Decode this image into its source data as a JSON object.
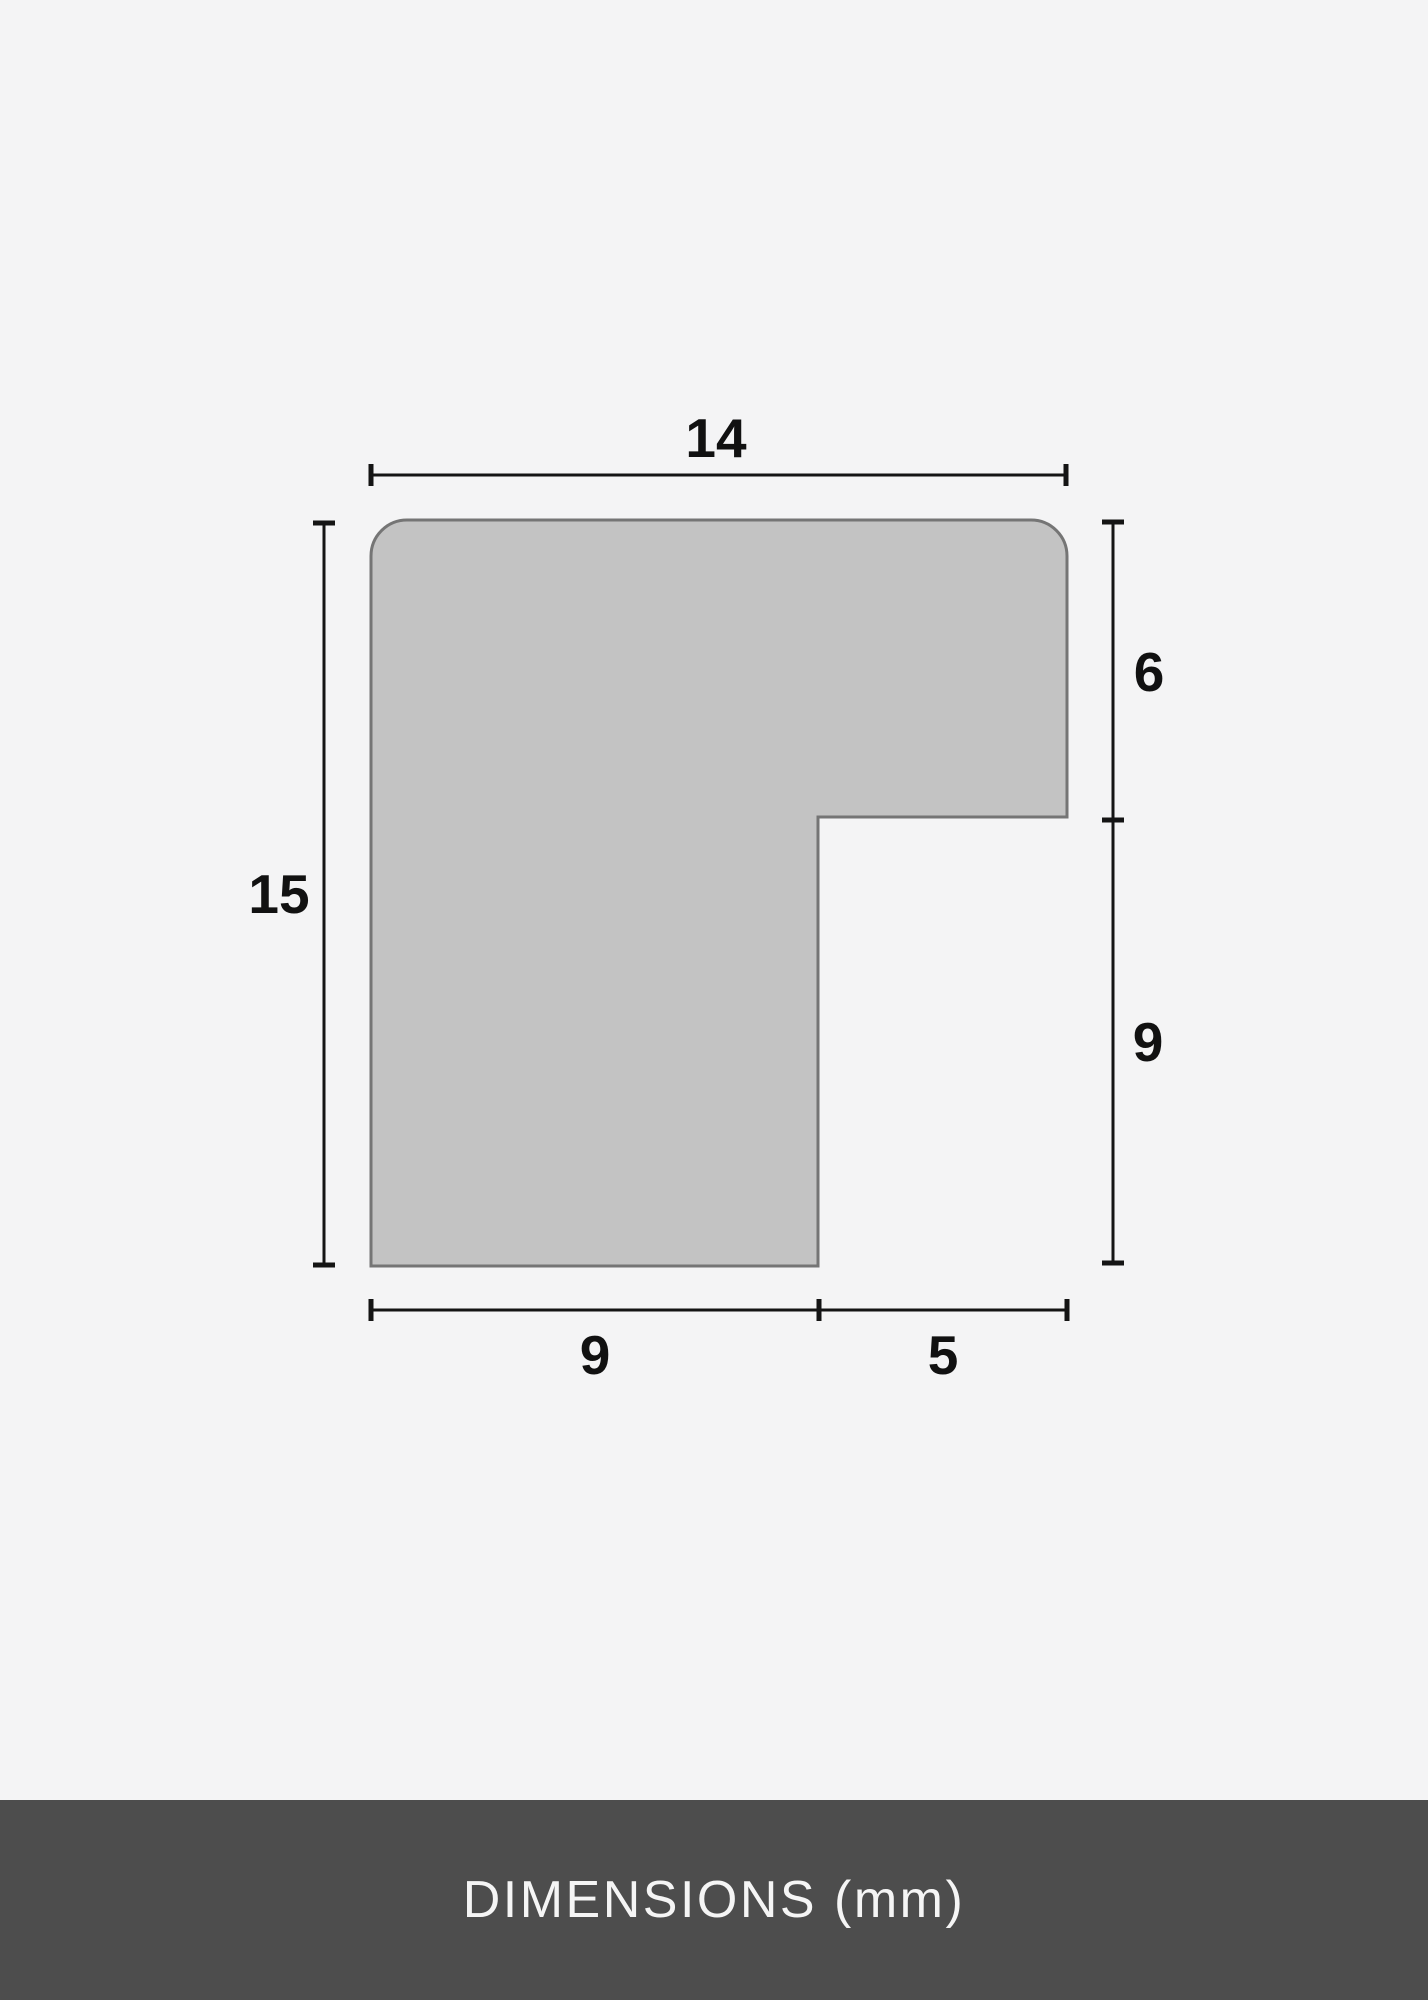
{
  "diagram": {
    "unit": "mm",
    "dimensions": {
      "top_width": "14",
      "left_height": "15",
      "right_upper": "6",
      "right_lower": "9",
      "bottom_left": "9",
      "bottom_right": "5"
    }
  },
  "footer": {
    "label": "DIMENSIONS (mm)"
  },
  "colors": {
    "background": "#f4f4f5",
    "shape_fill": "#c3c3c3",
    "shape_stroke": "#757575",
    "dimension_line": "#141414",
    "dimension_text": "#111111",
    "footer_background": "#4d4d4d",
    "footer_text": "#f5f5f5"
  }
}
